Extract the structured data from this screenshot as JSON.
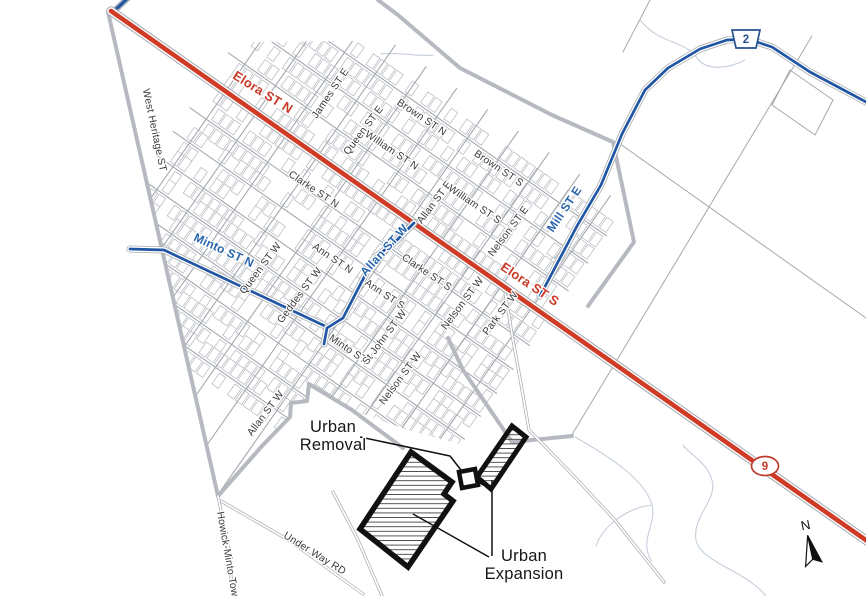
{
  "map_title": "Town street map with urban expansion and removal areas",
  "colors": {
    "background": "#ffffff",
    "street_thin": "#a4a9af",
    "parcel": "#b7bbc1",
    "gray_thick": "#b6bac0",
    "casing": "#a8adb3",
    "highway_red": "#d03b26",
    "highway_blue": "#2156a5",
    "creek": "#c5cfda",
    "urban_outline": "#111111",
    "label_black": "#3a3a3a",
    "label_red": "#c93a28",
    "label_blue": "#2b66ad"
  },
  "labels": [
    {
      "id": "james-st-e",
      "text": "James ST E",
      "x": 330,
      "y": 93,
      "rot": -56,
      "cls": "st",
      "size": 10.3
    },
    {
      "id": "queen-st-e",
      "text": "Queen ST E",
      "x": 363,
      "y": 130,
      "rot": -53,
      "cls": "st",
      "size": 10.3
    },
    {
      "id": "william-st-n",
      "text": "William ST N",
      "x": 392,
      "y": 150,
      "rot": 34,
      "cls": "st",
      "size": 10.3
    },
    {
      "id": "brown-st-n",
      "text": "Brown ST N",
      "x": 422,
      "y": 117,
      "rot": 34,
      "cls": "st",
      "size": 10.3
    },
    {
      "id": "brown-st-s",
      "text": "Brown ST S",
      "x": 499,
      "y": 168,
      "rot": 34,
      "cls": "st",
      "size": 10.3
    },
    {
      "id": "allan-st-e",
      "text": "Allan ST E",
      "x": 434,
      "y": 202,
      "rot": -53,
      "cls": "st",
      "size": 10.3
    },
    {
      "id": "william-st-s",
      "text": "William ST S",
      "x": 475,
      "y": 204,
      "rot": 34,
      "cls": "st",
      "size": 10.3
    },
    {
      "id": "nelson-st-e",
      "text": "Nelson ST E",
      "x": 508,
      "y": 231,
      "rot": -53,
      "cls": "st",
      "size": 10.3
    },
    {
      "id": "clarke-st-n",
      "text": "Clarke ST N",
      "x": 314,
      "y": 189,
      "rot": 34,
      "cls": "st",
      "size": 10.3
    },
    {
      "id": "ann-st-n",
      "text": "Ann ST N",
      "x": 333,
      "y": 258,
      "rot": 34,
      "cls": "st",
      "size": 10.3
    },
    {
      "id": "queen-st-w",
      "text": "Queen ST W",
      "x": 260,
      "y": 268,
      "rot": -53,
      "cls": "st",
      "size": 10.3
    },
    {
      "id": "geddes-st-w",
      "text": "Geddes ST W",
      "x": 299,
      "y": 295,
      "rot": -53,
      "cls": "st",
      "size": 10.3
    },
    {
      "id": "clarke-st-s",
      "text": "Clarke ST S",
      "x": 427,
      "y": 272,
      "rot": 34,
      "cls": "st",
      "size": 10.3
    },
    {
      "id": "ann-st-s",
      "text": "Ann ST S",
      "x": 385,
      "y": 294,
      "rot": 34,
      "cls": "st",
      "size": 10.3
    },
    {
      "id": "minto-st",
      "text": "Minto ST.",
      "x": 349,
      "y": 349,
      "rot": 34,
      "cls": "st",
      "size": 10.3
    },
    {
      "id": "st-john-st-w",
      "text": "St John ST W",
      "x": 384,
      "y": 337,
      "rot": -53,
      "cls": "st",
      "size": 10.3
    },
    {
      "id": "nelson-st-w-upper",
      "text": "Nelson ST W",
      "x": 462,
      "y": 303,
      "rot": -53,
      "cls": "st",
      "size": 10.3
    },
    {
      "id": "park-st-w",
      "text": "Park ST W",
      "x": 500,
      "y": 313,
      "rot": -53,
      "cls": "st",
      "size": 10.3
    },
    {
      "id": "nelson-st-w-lower",
      "text": "Nelson ST W",
      "x": 400,
      "y": 378,
      "rot": -53,
      "cls": "st",
      "size": 10.3
    },
    {
      "id": "allan-st-w-lower",
      "text": "Allan ST W",
      "x": 265,
      "y": 413,
      "rot": -53,
      "cls": "st",
      "size": 10.3
    },
    {
      "id": "west-heritage-st",
      "text": "West Heritage ST",
      "x": 155,
      "y": 130,
      "rot": 78,
      "cls": "st",
      "size": 10.3
    },
    {
      "id": "howick-minto-townline",
      "text": "Howick-Minto Townline",
      "x": 230,
      "y": 565,
      "rot": 80,
      "cls": "st",
      "size": 10.3
    },
    {
      "id": "under-way-rd",
      "text": "Under Way RD",
      "x": 315,
      "y": 553,
      "rot": 32,
      "cls": "st",
      "size": 10.3
    },
    {
      "id": "elora-st-n",
      "text": "Elora ST N",
      "x": 263,
      "y": 92,
      "rot": 32,
      "cls": "red",
      "size": 13
    },
    {
      "id": "elora-st-s",
      "text": "Elora ST S",
      "x": 530,
      "y": 284,
      "rot": 34,
      "cls": "red",
      "size": 13
    },
    {
      "id": "minto-st-n",
      "text": "Minto ST N",
      "x": 224,
      "y": 250,
      "rot": 25,
      "cls": "blue",
      "size": 12
    },
    {
      "id": "allan-st-w-blue",
      "text": "Allan ST W",
      "x": 384,
      "y": 250,
      "rot": -48,
      "cls": "blue",
      "size": 12
    },
    {
      "id": "mill-st-e",
      "text": "Mill ST E",
      "x": 564,
      "y": 209,
      "rot": -56,
      "cls": "blue",
      "size": 12
    }
  ],
  "urban": {
    "removal": {
      "lines": [
        "Urban",
        "Removal"
      ],
      "label_x": 333,
      "label_y": [
        432,
        450
      ],
      "font_size": 16.5,
      "leader": [
        [
          360,
          437
        ],
        [
          450,
          456
        ],
        [
          461,
          470
        ]
      ],
      "square": [
        [
          459,
          472
        ],
        [
          475,
          469
        ],
        [
          478,
          485
        ],
        [
          462,
          488
        ]
      ]
    },
    "expansion": {
      "lines": [
        "Urban",
        "Expansion"
      ],
      "label_x": 524,
      "label_y": [
        561,
        579
      ],
      "font_size": 16.5,
      "leaders": [
        [
          [
            413,
            514
          ],
          [
            489,
            557
          ]
        ],
        [
          [
            492,
            480
          ],
          [
            492,
            556
          ]
        ]
      ],
      "main_polygon": [
        [
          411,
          452
        ],
        [
          452,
          482
        ],
        [
          444,
          494
        ],
        [
          453,
          501
        ],
        [
          408,
          567
        ],
        [
          360,
          529
        ]
      ],
      "strip_polygon": [
        [
          512,
          426
        ],
        [
          526,
          437
        ],
        [
          491,
          489
        ],
        [
          477,
          477
        ]
      ],
      "connector": [
        [
          474,
          478
        ],
        [
          484,
          484
        ]
      ]
    }
  },
  "shields": [
    {
      "id": "highway-2-shield",
      "shape": "pentagon",
      "text": "2",
      "x": 746,
      "y": 39,
      "stroke": "#27508f",
      "fill": "#ffffff"
    },
    {
      "id": "highway-9-shield",
      "shape": "ellipse",
      "text": "9",
      "x": 765,
      "y": 466,
      "stroke": "#c23b2a",
      "fill": "#ffffff"
    }
  ],
  "north": {
    "label": "N",
    "x": 811,
    "y": 551,
    "rot": -12
  },
  "roads": {
    "elora": [
      [
        111,
        11
      ],
      [
        880,
        550
      ]
    ],
    "hwy9_stub": [
      [
        128,
        -2
      ],
      [
        113,
        12
      ]
    ],
    "blue_routes": [
      [
        [
          130,
          249
        ],
        [
          164,
          250
        ],
        [
          327,
          327
        ]
      ],
      [
        [
          414,
          223
        ],
        [
          394,
          243
        ],
        [
          374,
          258
        ],
        [
          343,
          318
        ],
        [
          327,
          328
        ],
        [
          324,
          344
        ]
      ],
      [
        [
          540,
          296
        ],
        [
          577,
          226
        ],
        [
          601,
          185
        ],
        [
          622,
          134
        ],
        [
          645,
          90
        ],
        [
          668,
          68
        ],
        [
          700,
          49
        ],
        [
          727,
          40
        ],
        [
          748,
          39
        ],
        [
          772,
          47
        ],
        [
          810,
          72
        ],
        [
          868,
          103
        ]
      ]
    ],
    "gray_thick": [
      [
        [
          108,
          12
        ],
        [
          218,
          496
        ]
      ],
      [
        [
          218,
          496
        ],
        [
          262,
          446
        ],
        [
          290,
          417
        ],
        [
          291,
          403
        ],
        [
          307,
          401
        ],
        [
          309,
          384
        ]
      ],
      [
        [
          309,
          384
        ],
        [
          352,
          410
        ],
        [
          403,
          448
        ]
      ],
      [
        [
          378,
          0
        ],
        [
          398,
          15
        ],
        [
          460,
          68
        ],
        [
          552,
          115
        ],
        [
          613,
          142
        ],
        [
          634,
          242
        ],
        [
          588,
          306
        ]
      ],
      [
        [
          448,
          338
        ],
        [
          463,
          370
        ],
        [
          512,
          442
        ],
        [
          572,
          436
        ]
      ]
    ],
    "cased_thin": [
      [
        [
          505,
          292
        ],
        [
          513,
          340
        ],
        [
          521,
          384
        ],
        [
          529,
          430
        ],
        [
          570,
          472
        ],
        [
          614,
          519
        ],
        [
          664,
          582
        ]
      ],
      [
        [
          221,
          501
        ],
        [
          290,
          541
        ],
        [
          363,
          594
        ]
      ],
      [
        [
          218,
          496
        ],
        [
          228,
          545
        ],
        [
          233,
          598
        ]
      ],
      [
        [
          333,
          492
        ],
        [
          358,
          540
        ],
        [
          383,
          598
        ]
      ]
    ],
    "thin": [
      [
        [
          570,
          438
        ],
        [
          812,
          36
        ]
      ],
      [
        [
          616,
          141
        ],
        [
          866,
          318
        ]
      ],
      [
        [
          650,
          0
        ],
        [
          623,
          52
        ]
      ],
      [
        [
          790,
          70
        ],
        [
          833,
          100
        ],
        [
          815,
          135
        ],
        [
          772,
          105
        ],
        [
          790,
          70
        ]
      ]
    ],
    "creeks": [
      "M640,20 C660,45 685,40 697,58 C707,72 730,68 745,60",
      "M766,596 C745,570 700,562 696,540 C692,516 718,500 712,480 C707,462 690,455 683,445",
      "M545,264 C555,252 570,258 578,247",
      "M575,437 C612,458 645,480 652,505 C657,525 638,540 652,562",
      "M652,505 C625,508 602,528 596,546",
      "M380,54 C400,52 420,57 434,55"
    ]
  },
  "grid": {
    "origin": [
      111,
      11
    ],
    "cos": 0.8192,
    "sin": 0.5736,
    "a_streets": [
      -100,
      -67,
      -33,
      34,
      63,
      92,
      120,
      148,
      176,
      204,
      232
    ],
    "a_range": [
      120,
      535
    ],
    "b_start": 140,
    "b_step": 37.5,
    "b_end": 518,
    "b_range": [
      -135,
      345
    ],
    "parcel_streets": [
      -100,
      -67,
      -33,
      0,
      34,
      63,
      92,
      120,
      148,
      176,
      204,
      232
    ],
    "parcel": {
      "step": 9.5,
      "len": 7.8,
      "gap": 2.5,
      "depth": 13,
      "skip": 0.3,
      "u_start": 135,
      "u_end": 525
    },
    "seed": 11,
    "clip": [
      [
        121,
        58
      ],
      [
        240,
        42
      ],
      [
        470,
        40
      ],
      [
        540,
        78
      ],
      [
        600,
        122
      ],
      [
        648,
        150
      ],
      [
        652,
        248
      ],
      [
        590,
        308
      ],
      [
        523,
        400
      ],
      [
        470,
        447
      ],
      [
        408,
        430
      ],
      [
        352,
        410
      ],
      [
        309,
        384
      ],
      [
        307,
        401
      ],
      [
        291,
        403
      ],
      [
        290,
        417
      ],
      [
        262,
        446
      ],
      [
        218,
        496
      ],
      [
        196,
        400
      ],
      [
        137,
        128
      ]
    ]
  }
}
